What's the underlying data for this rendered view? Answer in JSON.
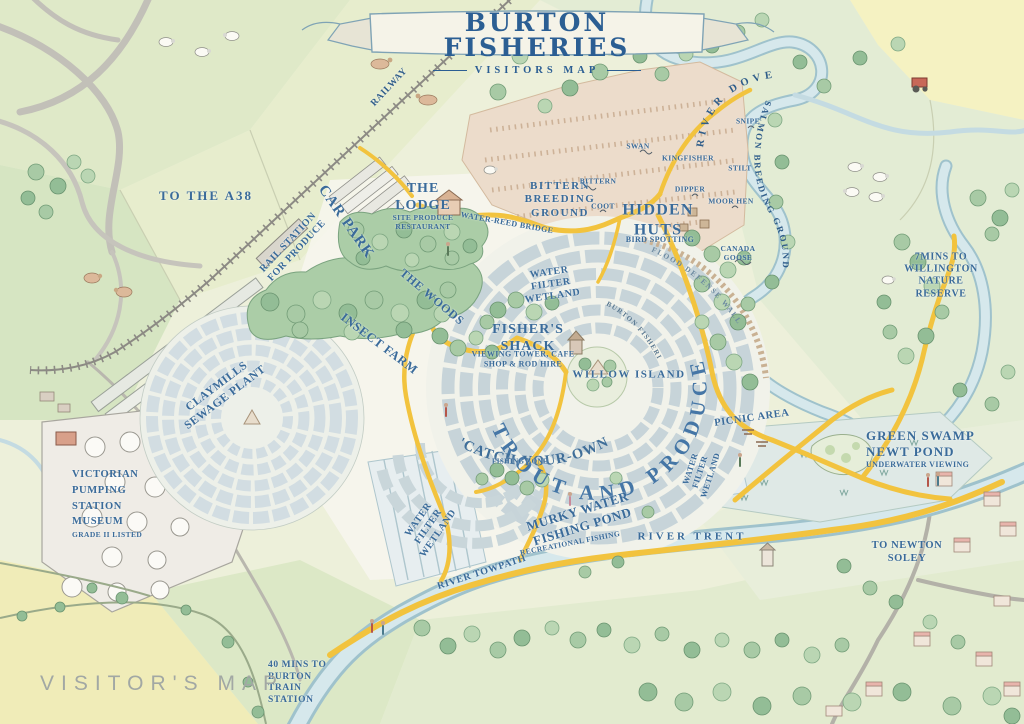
{
  "banner": {
    "title": "BURTON FISHERIES",
    "subtitle": "VISITORS MAP"
  },
  "watermark": "VISITOR'S MAP",
  "labels": {
    "railway": "RAILWAY",
    "toA38": "TO THE A38",
    "carPark": "CAR PARK",
    "railStation": "RAIL STATION\nFOR PRODUCE",
    "lodge": "THE\nLODGE",
    "lodgeSub": "SITE PRODUCE\nRESTAURANT",
    "waterReedBridge": "WATER-REED BRIDGE",
    "bitternGround": "BITTERN\nBREEDING\nGROUND",
    "bittern": "BITTERN",
    "coot": "COOT",
    "swan": "SWAN",
    "kingfisher": "KINGFISHER",
    "snipe": "SNIPE",
    "stilt": "STILT",
    "dipper": "DIPPER",
    "moorHen": "MOOR HEN",
    "canadaGoose": "CANADA\nGOOSE",
    "hiddenHuts": "HIDDEN\nHUTS",
    "birdSpotting": "BIRD SPOTTING",
    "riverDove": "RIVER DOVE",
    "salmonGround": "SALMON BREEDING GROUND",
    "willington": "7MINS TO\nWILLINGTON\nNATURE RESERVE",
    "theWoods": "THE WOODS",
    "waterFilterWetlandC": "WATER\nFILTER\nWETLAND",
    "fishersShack": "FISHER'S\nSHACK",
    "fishersShackSub": "VIEWING TOWER, CAFE\nSHOP & ROD HIRE",
    "willowIsland": "WILLOW ISLAND",
    "burtonFisheriesPath": "BURTON FISHERIES",
    "floodWall": "FLOOD DEFENSE WALL",
    "troutProduce": "TROUT AND PRODUCE",
    "insectFarm": "INSECT FARM",
    "claymills": "CLAYMILLS\nSEWAGE PLANT",
    "victorian": "VICTORIAN\nPUMPING\nSTATION\nMUSEUM",
    "victorianSub": "GRADE II LISTED",
    "catchYourOwn": "'CATCH-YOUR-OWN'",
    "fishingZone": "FISHING ZONE",
    "murky": "MURKY WATER\nFISHING POND",
    "murkySub": "RECREATIONAL FISHING",
    "waterFilterWetlandL": "WATER\nFILTER\nWETLAND",
    "riverTowpath": "RIVER TOWPATH",
    "riverTrent": "RIVER TRENT",
    "picnicArea": "PICNIC AREA",
    "waterFilterWetlandR": "WATER\nFILTER\nWETLAND",
    "greenSwamp": "GREEN SWAMP\nNEWT POND",
    "greenSwampSub": "UNDERWATER VIEWING",
    "toNewtonSoley": "TO NEWTON\nSOLEY",
    "burtonStation": "40 MINS TO\nBURTON\nTRAIN\nSTATION"
  },
  "colors": {
    "label_blue": "#3a6b9a",
    "path_yellow": "#f2c33e",
    "water": "#d6e8ec",
    "water_edge": "#9fc2cc",
    "tree_green": "#a8caa5",
    "field_green": "#dfe9c8",
    "field_yellow": "#f4f1c2",
    "marsh_tan": "#ecdccb",
    "road_gray": "#bdbab2",
    "ribbon_edge": "#7fa3b5"
  },
  "icons": [
    "tree-icon",
    "sheep-icon",
    "cow-icon",
    "horse-icon",
    "bird-icon",
    "tractor-icon",
    "house-icon",
    "person-icon",
    "picnic-table-icon",
    "ribbon-banner-icon"
  ]
}
